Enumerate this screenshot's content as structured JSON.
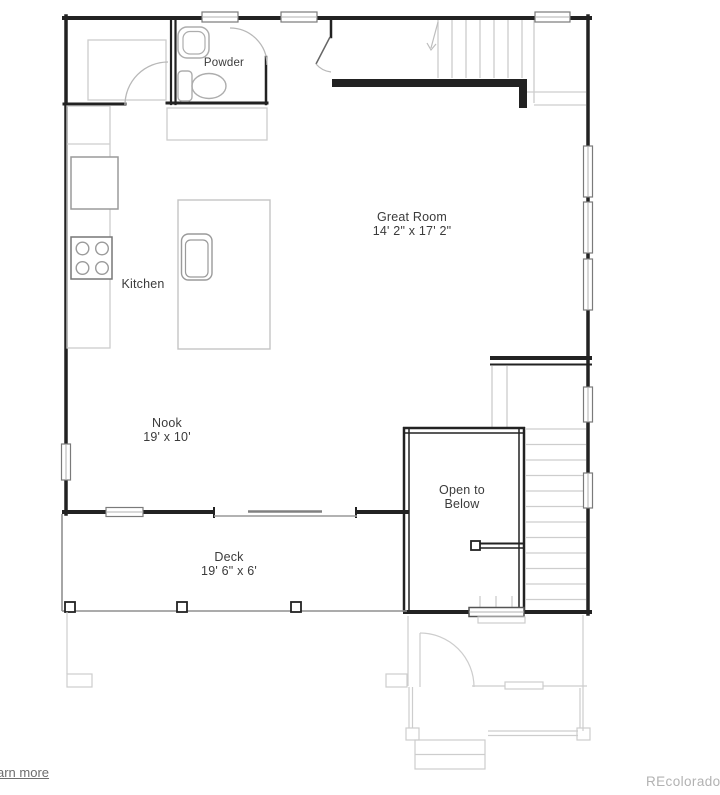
{
  "rooms": {
    "powder": "Powder",
    "kitchen": "Kitchen",
    "great_room": {
      "name": "Great Room",
      "dimensions": "14' 2\" x 17' 2\""
    },
    "nook": {
      "name": "Nook",
      "dimensions": "19' x 10'"
    },
    "deck": {
      "name": "Deck",
      "dimensions": "19' 6\" x 6'"
    },
    "open_to_below": "Open to Below"
  },
  "fixtures": [
    "pantry",
    "refrigerator",
    "range",
    "island-sink",
    "powder-sink",
    "toilet",
    "stairs-up",
    "stairs-down",
    "sliding-door",
    "deck-posts",
    "porch-steps"
  ],
  "footer": {
    "learn_more_link": "arn more",
    "watermark": "REcolorado"
  },
  "colors": {
    "wall": "#222222",
    "fixture_line": "#adadad",
    "light_line": "#cdcdcd",
    "deck_line": "#8f8f8f",
    "text": "#3b3b3b",
    "watermark": "#b2b2b2",
    "link": "#6e6e6e"
  }
}
